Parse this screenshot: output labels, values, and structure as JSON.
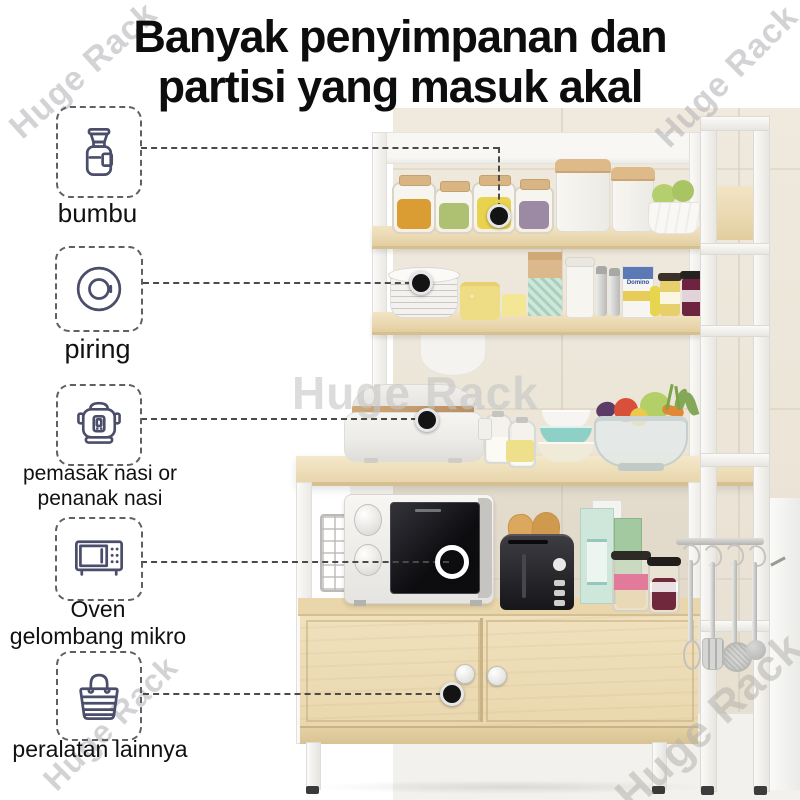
{
  "title": {
    "line1": "Banyak penyimpanan dan",
    "line2": "partisi yang masuk akal"
  },
  "watermark": {
    "text": "Huge Rack"
  },
  "callouts": [
    {
      "icon": "spice-jar-icon",
      "lines": [
        "bumbu"
      ]
    },
    {
      "icon": "plate-icon",
      "lines": [
        "piring"
      ]
    },
    {
      "icon": "rice-cooker-icon",
      "lines": [
        "pemasak nasi or",
        "penanak nasi"
      ]
    },
    {
      "icon": "microwave-icon",
      "lines": [
        "Oven",
        "gelombang mikro"
      ]
    },
    {
      "icon": "shopping-bag-icon",
      "lines": [
        "peralatan lainnya"
      ]
    }
  ],
  "photo": {
    "box_label": "Domino"
  },
  "colors": {
    "icon_stroke": "#4b4e6b",
    "title_text": "#0d0d0d",
    "connector": "#4a4a4a",
    "wood": "#ead9b2",
    "frame_white": "#f7f6f3",
    "watermark_gray": "#b0b0b6"
  }
}
